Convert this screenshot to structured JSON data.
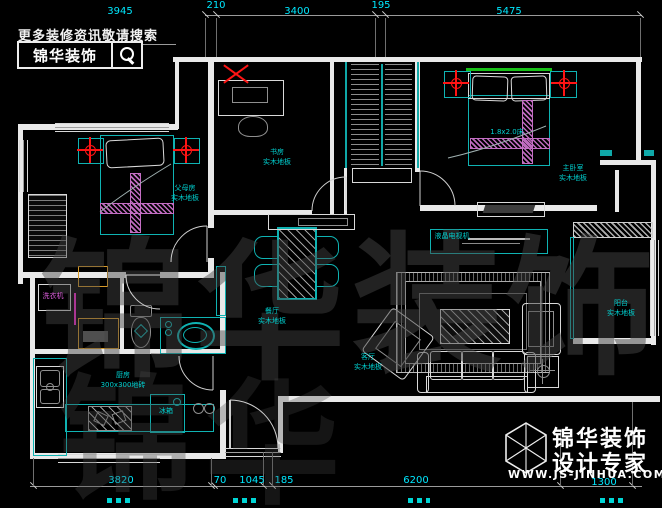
{
  "header": {
    "promo_text": "更多装修资讯敬请搜索",
    "brand": "锦华装饰",
    "search_icon": "magnifier-icon"
  },
  "footer": {
    "brand_line1": "锦华装饰",
    "brand_line2": "设计专家",
    "url": "WWW.JS-JINHUA.COM",
    "logo_icon": "cube-logo-icon"
  },
  "colors": {
    "background": "#000000",
    "wall": "#e9e9e9",
    "furniture_cyan": "#0fb3b3",
    "dimension_text": "#00e8ff",
    "hatch_magenta": "#c46ec4",
    "light_symbol_red": "#ff1414",
    "window_green": "#17c017",
    "cabinet_orange": "#d89a28",
    "door_highlight_magenta": "#ff2ad4",
    "watermark_gray": "#454545"
  },
  "watermark": {
    "text": "锦华装饰",
    "extra_row": "锦华"
  },
  "dimensions": {
    "top": [
      {
        "label": "3945",
        "x": 120,
        "y": 6
      },
      {
        "label": "210",
        "x": 216,
        "y": 0
      },
      {
        "label": "3400",
        "x": 297,
        "y": 6
      },
      {
        "label": "195",
        "x": 381,
        "y": 0
      },
      {
        "label": "5475",
        "x": 509,
        "y": 6
      }
    ],
    "bottom": [
      {
        "label": "3820",
        "x": 121,
        "y": 475
      },
      {
        "label": "70",
        "x": 220,
        "y": 475
      },
      {
        "label": "1045",
        "x": 252,
        "y": 475
      },
      {
        "label": "185",
        "x": 284,
        "y": 475
      },
      {
        "label": "6200",
        "x": 416,
        "y": 475
      },
      {
        "label": "1300",
        "x": 604,
        "y": 477
      }
    ]
  },
  "labels": {
    "rooms": [
      {
        "name": "parents-bedroom",
        "x": 185,
        "y": 183,
        "lines": [
          "父母房",
          "实木地板"
        ]
      },
      {
        "name": "study",
        "x": 277,
        "y": 147,
        "lines": [
          "书房",
          "实木地板"
        ]
      },
      {
        "name": "master-bedroom",
        "x": 573,
        "y": 163,
        "lines": [
          "主卧室",
          "实木地板"
        ]
      },
      {
        "name": "dining-room",
        "x": 272,
        "y": 306,
        "lines": [
          "餐厅",
          "实木地板"
        ]
      },
      {
        "name": "living-room",
        "x": 368,
        "y": 352,
        "lines": [
          "客厅",
          "实木地板"
        ]
      },
      {
        "name": "kitchen",
        "x": 123,
        "y": 370,
        "lines": [
          "厨房",
          "300x300地砖"
        ]
      },
      {
        "name": "balcony",
        "x": 621,
        "y": 298,
        "lines": [
          "阳台",
          "实木地板"
        ]
      }
    ],
    "items": [
      {
        "name": "bed-size-label",
        "x": 507,
        "y": 127,
        "text": "1.8x2.0床"
      },
      {
        "name": "tv-label",
        "x": 452,
        "y": 231,
        "text": "液晶电视机"
      },
      {
        "name": "washing-machine-label",
        "x": 53,
        "y": 291,
        "text": "洗衣机",
        "color": "magenta"
      },
      {
        "name": "fridge-label",
        "x": 166,
        "y": 406,
        "text": "冰箱"
      }
    ]
  }
}
